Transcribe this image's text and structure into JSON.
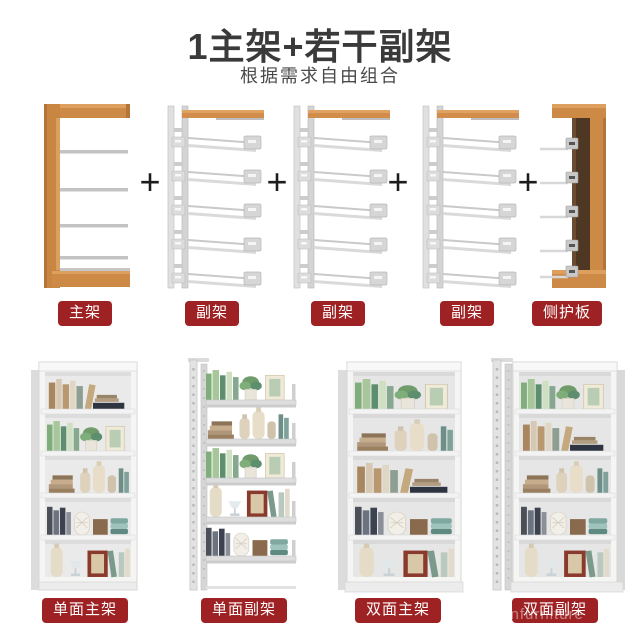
{
  "header": {
    "title": "1主架+若干副架",
    "subtitle": "根据需求自由组合"
  },
  "plus_sign": "+",
  "top_row": {
    "items": [
      {
        "label": "主架"
      },
      {
        "label": "副架"
      },
      {
        "label": "副架"
      },
      {
        "label": "副架"
      },
      {
        "label": "侧护板"
      }
    ]
  },
  "bottom_row": {
    "items": [
      {
        "label": "单面主架"
      },
      {
        "label": "单面副架"
      },
      {
        "label": "双面主架"
      },
      {
        "label": "双面副架"
      }
    ]
  },
  "watermark": "cnfurniture",
  "colors": {
    "label_bg": "#9e2123",
    "label_text": "#ffffff",
    "title_text": "#3a3a3a",
    "wood": "#cd8a46",
    "steel": "#dcdcdc"
  }
}
